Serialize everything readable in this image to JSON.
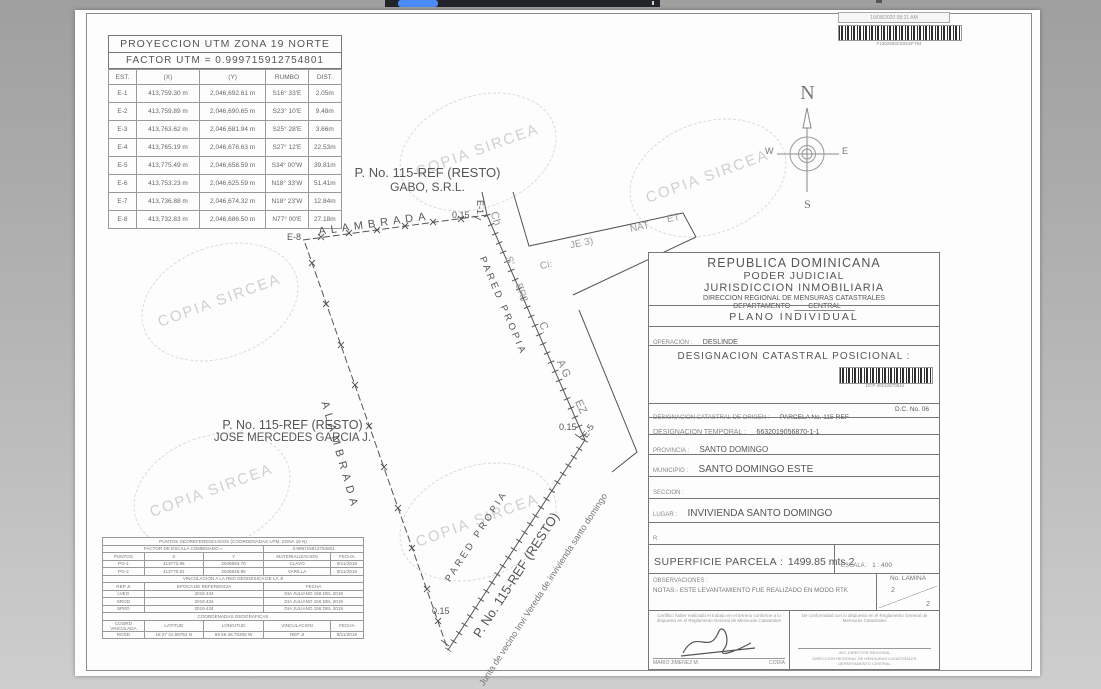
{
  "chrome": {
    "tab_color": "#4b8bf5"
  },
  "scan_stamp": {
    "datetime": "19/08/2020 08:21 AM",
    "code": "F1302693C031mF794"
  },
  "watermark": {
    "text": "COPIA SIRCEA"
  },
  "utm_table": {
    "title": "PROYECCION UTM ZONA 19 NORTE",
    "factor": "FACTOR UTM = 0.999715912754801",
    "rows": [
      [
        "EST.",
        "(X)",
        "(Y)",
        "RUMBO",
        "DIST."
      ],
      [
        "E-1",
        "413,759.30 m",
        "2,046,692.61 m",
        "S16° 33'E",
        "2.05m"
      ],
      [
        "E-2",
        "413,759.89 m",
        "2,046,690.65 m",
        "S23° 10'E",
        "9.48m"
      ],
      [
        "E-3",
        "413,763.62 m",
        "2,046,681.94 m",
        "S25° 28'E",
        "3.66m"
      ],
      [
        "E-4",
        "413,765.19 m",
        "2,046,678.63 m",
        "S27° 12'E",
        "22.53m"
      ],
      [
        "E-5",
        "413,775.49 m",
        "2,046,658.59 m",
        "S34° 00'W",
        "39.81m"
      ],
      [
        "E-6",
        "413,753.23 m",
        "2,046,625.59 m",
        "N18° 33'W",
        "51.41m"
      ],
      [
        "E-7",
        "413,736.88 m",
        "2,046,674.32 m",
        "N18° 23'W",
        "12.84m"
      ],
      [
        "E-8",
        "413,732.83 m",
        "2,046,686.50 m",
        "N77° 00'E",
        "27.18m"
      ]
    ]
  },
  "compass": {
    "n": "N",
    "e": "E",
    "s": "S",
    "w": "W"
  },
  "plot": {
    "gabo_line1": "P. No. 115-REF (RESTO)",
    "gabo_line2": "GABO, S.R.L.",
    "jose_line1": "P. No. 115-REF (RESTO)",
    "jose_line2": "JOSE MERCEDES GARCIA J.",
    "alambrada_top": "ALAMBRADA",
    "alambrada_west": "ALAMBRADA",
    "pared_propia_east": "PARED PROPIA",
    "pared_propia_sw": "PARED PROPIA",
    "parcel_rest": "P. No. 115-REF (RESTO)",
    "junta": "Junta de vecino Invi Vereda de invivienda santo domingo",
    "e1": "E-1",
    "e5": "E-5",
    "e8": "E-8",
    "d015_a": "0.15",
    "d015_b": "0.15",
    "d015_c": "0.15",
    "frag_ch": "Ch",
    "frag_s": "S'",
    "frag_erj": "ERJ",
    "frag_ci": "Ci:",
    "frag_je": "JE 3)",
    "frag_nat": "NAT",
    "frag_et": "ET",
    "frag_c": "C.",
    "frag_ag": "A G",
    "frag_ez": "EZ"
  },
  "geo_table": {
    "rows": [
      [
        [
          "PUNTOS GEOREFERENCIADOS (COORDENADAS UTM, ZONA 19 N)",
          5
        ]
      ],
      [
        [
          "FACTOR DE ESCALA COMBINADO =",
          3
        ],
        [
          "0.999715912754801",
          2
        ]
      ],
      [
        [
          "PUNTOS",
          1
        ],
        [
          "X",
          1
        ],
        [
          "Y",
          1
        ],
        [
          "MATERIALIZACION",
          1
        ],
        [
          "FECHA",
          1
        ]
      ],
      [
        [
          "PG-1",
          1
        ],
        [
          "413772.95",
          1
        ],
        [
          "2046693.70",
          1
        ],
        [
          "CLAVO",
          1
        ],
        [
          "9/11/2019",
          1
        ]
      ],
      [
        [
          "PG-2",
          1
        ],
        [
          "413776.81",
          1
        ],
        [
          "2046649.85",
          1
        ],
        [
          "VARILLA",
          1
        ],
        [
          "9/11/2019",
          1
        ]
      ],
      [
        [
          "VINCULACION A LA RED GEODESICA DE LA JI",
          5
        ]
      ],
      [
        [
          "REP JI",
          1
        ],
        [
          "EPOCA DE REFERENCIA",
          2
        ],
        [
          "FECHA",
          2
        ]
      ],
      [
        [
          "LVEG",
          1
        ],
        [
          "2019.434",
          2
        ],
        [
          "DIA JULIANO 158 DEL 2019",
          2
        ]
      ],
      [
        [
          "SROD",
          1
        ],
        [
          "2019.434",
          2
        ],
        [
          "DIA JULIANO 158 DEL 2019",
          2
        ]
      ],
      [
        [
          "SPED",
          1
        ],
        [
          "2019.434",
          2
        ],
        [
          "DIA JULIANO 158 DEL 2019",
          2
        ]
      ],
      [
        [
          "COORDENADAS GEOGRAFICAS",
          5
        ]
      ],
      [
        [
          "COORD VINCULADA",
          1
        ],
        [
          "LATITUD",
          1
        ],
        [
          "LONGITUD",
          1
        ],
        [
          "VINCULACION",
          1
        ],
        [
          "FECHA",
          1
        ]
      ],
      [
        [
          "ROSD",
          1
        ],
        [
          "18 27 41.69752 N",
          1
        ],
        [
          "69 56 46.76305 W",
          1
        ],
        [
          "REP JI",
          1
        ],
        [
          "9/11/2019",
          1
        ]
      ]
    ]
  },
  "title_block": {
    "country": "REPUBLICA DOMINICANA",
    "judicial": "PODER JUDICIAL",
    "jurisdiccion": "JURISDICCION INMOBILIARIA",
    "direccion": "DIRECCION REGIONAL DE MENSURAS CATASTRALES",
    "departamento_label": "DEPARTAMENTO",
    "departamento_value": "CENTRAL",
    "plano": "PLANO INDIVIDUAL",
    "operacion_label": "OPERACION :",
    "operacion_value": "DESLINDE",
    "dcp_title": "DESIGNACION CATASTRAL POSICIONAL :",
    "dcp_code": "DCP 40142670544",
    "origen_label": "DESIGNACION CATASTRAL DE ORIGEN :",
    "origen_value": "PARCELA No. 115-REF",
    "dc_value": "D.C. No. 06",
    "temporal_label": "DESIGNACION TEMPORAL :",
    "temporal_value": "6632019056870-1-1",
    "provincia_label": "PROVINCIA :",
    "provincia_value": "SANTO DOMINGO",
    "municipio_label": "MUNICIPIO :",
    "municipio_value": "SANTO DOMINGO ESTE",
    "seccion_label": "SECCION :",
    "lugar_label": "LUGAR :",
    "lugar_value": "INVIVIENDA SANTO DOMINGO",
    "r_mark": "R",
    "superficie_label": "SUPERFICIE PARCELA :",
    "superficie_value": "1499.85 mts.2",
    "escala_label": "ESCALA :",
    "escala_value": "1 : 400",
    "observaciones": "OBSERVACIONES :",
    "notas": "NOTAS:- ESTE LEVANTAMIENTO FUE REALIZADO EN MODO RTK",
    "lamina_label": "No. LAMINA",
    "lamina_num": "2",
    "lamina_den": "2",
    "cert_left": "Certifico haber realizado el trabajo en el terreno conforme a lo dispuesto en el Reglamento General de Mensuras Catastrales",
    "cert_right": "De conformidad con lo dispuesto en el Reglamento General de Mensuras Catastrales",
    "surveyor_name": "MARIO JIMENEZ M.",
    "codia": "CODIA",
    "dir_line1": "ING. DIRECTOR REGIONAL",
    "dir_line2": "DIRECCION REGIONAL DE MENSURAS CATASTRALES",
    "dir_line3": "DEPARTAMENTO CENTRAL"
  }
}
